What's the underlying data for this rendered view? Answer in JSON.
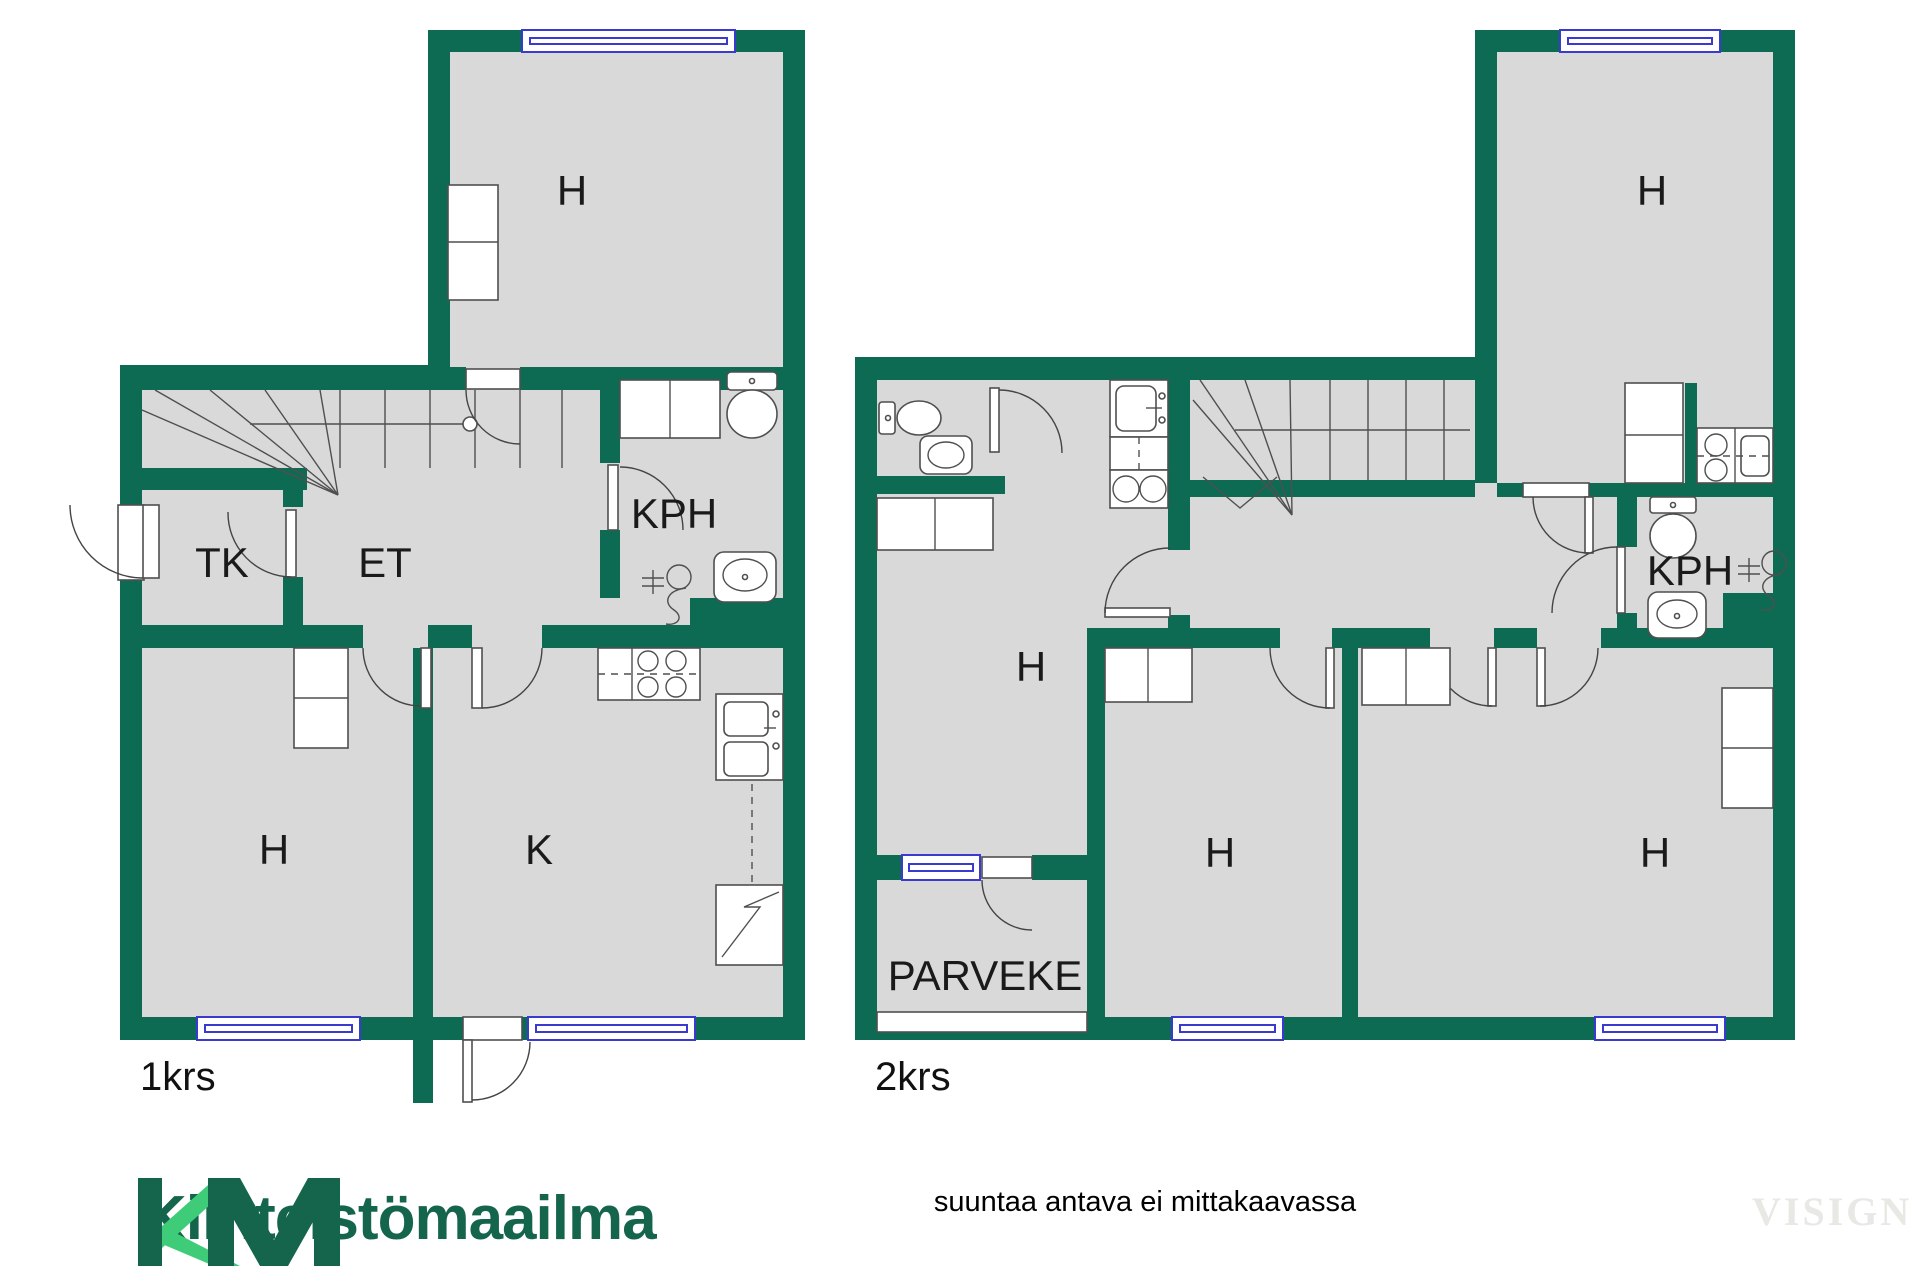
{
  "colors": {
    "wall_green": "#0e6b53",
    "room_fill": "#d9d9d9",
    "window_blue": "#3a3ad1",
    "fixture_stroke": "#4f4f4f",
    "logo_dark_green": "#14654c",
    "logo_light_green": "#3fcc79",
    "watermark_gray": "#e8e8e5"
  },
  "floor1": {
    "floor_label": "1krs",
    "rooms": {
      "bedroom_top": "H",
      "walk_in_closet": "TK",
      "entry_hall": "ET",
      "bathroom": "KPH",
      "bedroom": "H",
      "kitchen": "K"
    }
  },
  "floor2": {
    "floor_label": "2krs",
    "rooms": {
      "bedroom_top_right": "H",
      "room_left": "H",
      "room_middle": "H",
      "room_right": "H",
      "bathroom": "KPH",
      "balcony": "PARVEKE"
    }
  },
  "footer": {
    "brand_initials": "KM",
    "brand_name": "Kiinteistömaailma",
    "disclaimer": "suuntaa antava ei mittakaavassa",
    "watermark": "VISIGN"
  }
}
